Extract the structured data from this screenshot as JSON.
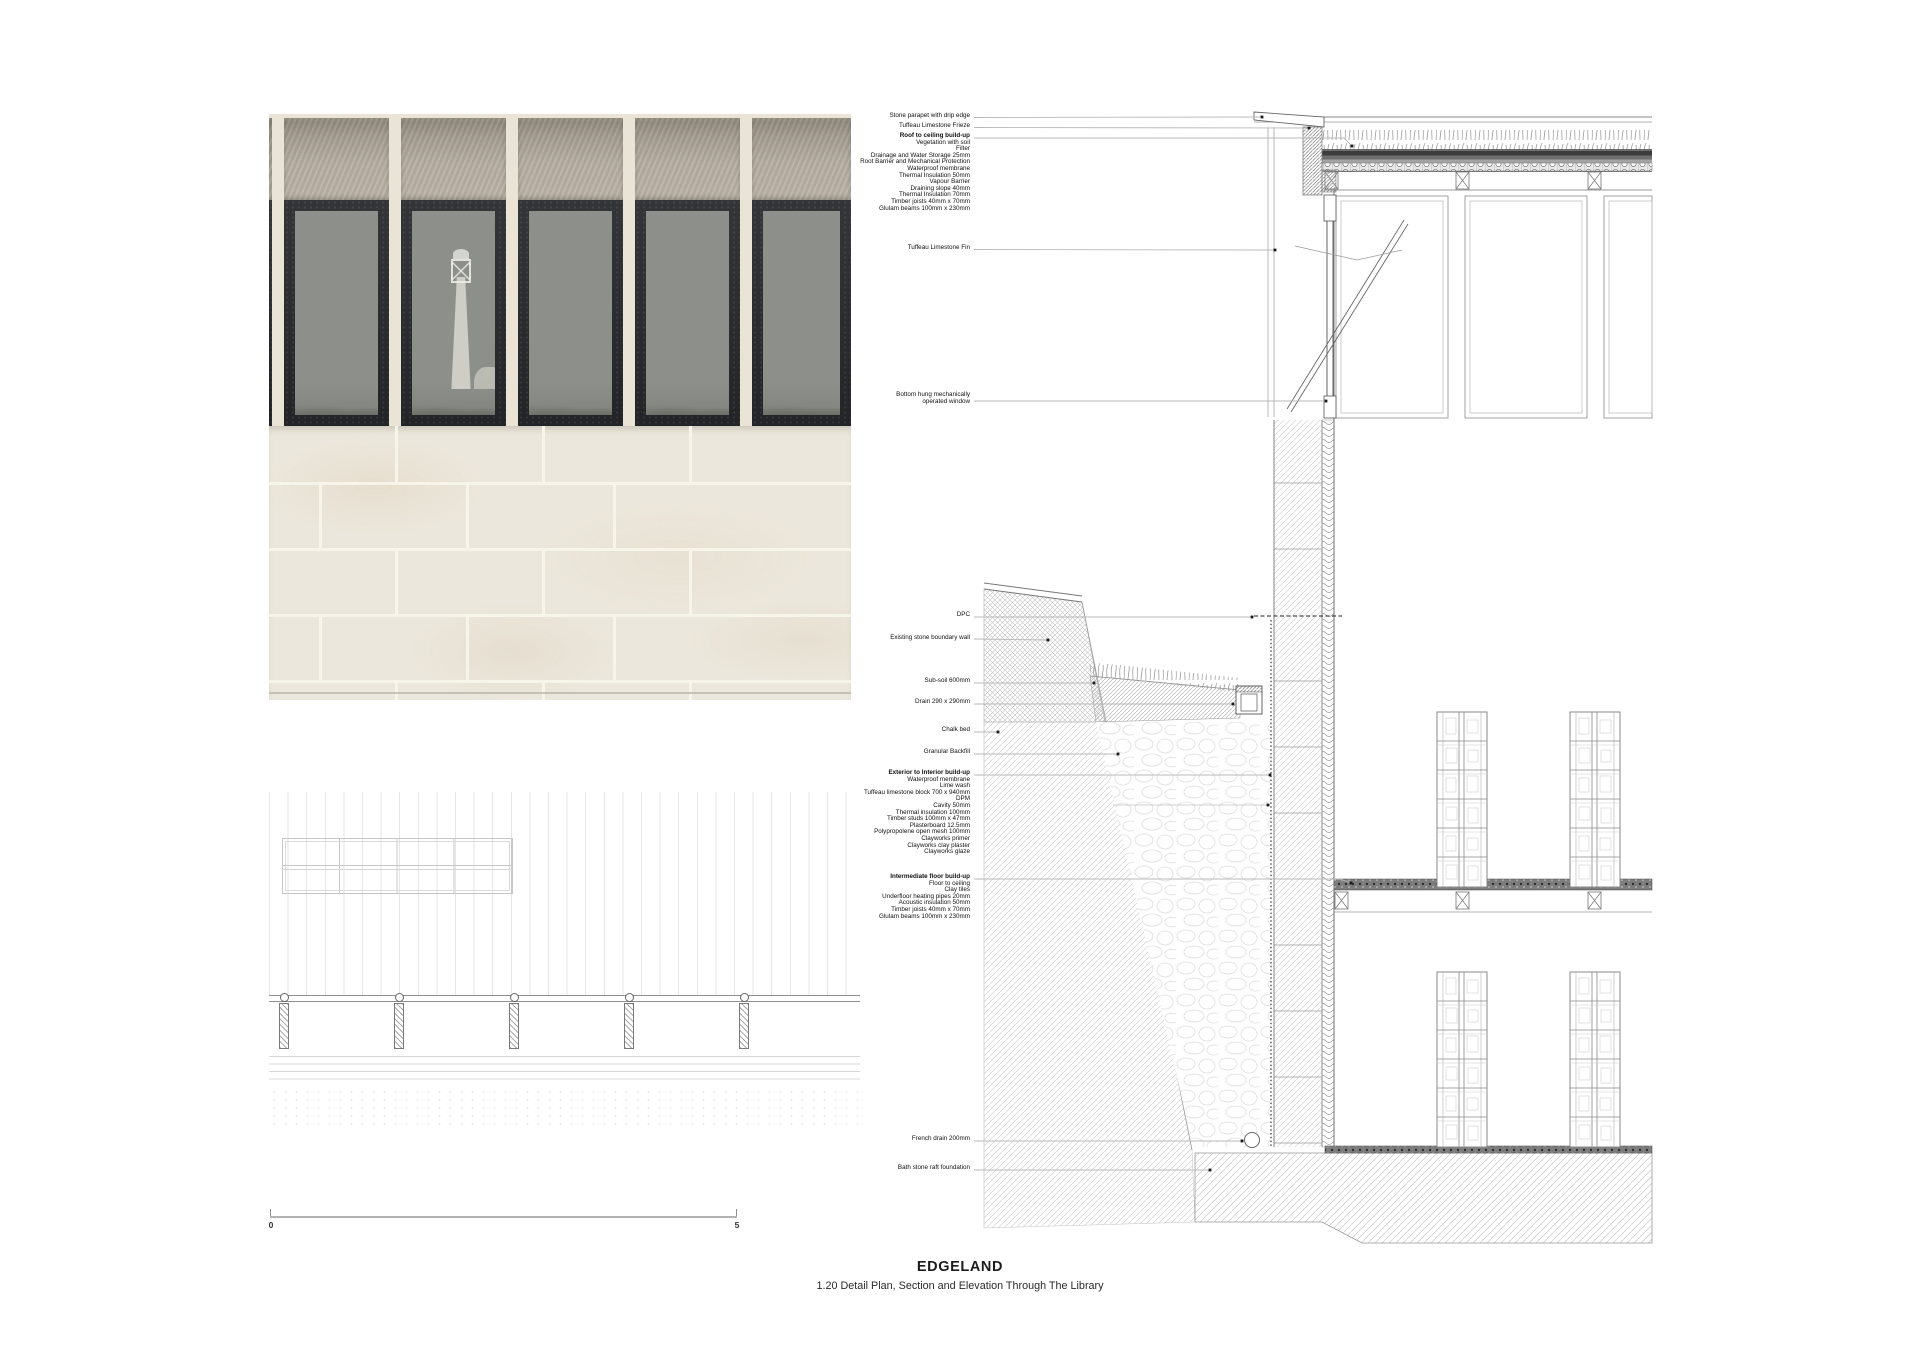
{
  "title_block": {
    "project": "EDGELAND",
    "drawing_title": "1.20 Detail Plan, Section and Elevation Through The Library"
  },
  "scale_bar": {
    "start_label": "0",
    "end_label": "5"
  },
  "colors": {
    "stone_cream": "#eae4d6",
    "frieze_grey": "#b2aa9d",
    "window_frame_charcoal": "#2d2e30",
    "glass_grey": "#8d908a",
    "drawing_line_grey": "#8a8a8a",
    "leader_grey": "#b9b9b9"
  },
  "annotations": [
    {
      "id": "stone-parapet",
      "heading": "Stone parapet with drip edge",
      "bold": false
    },
    {
      "id": "limestone-frieze",
      "heading": "Tuffeau Limestone Frieze",
      "bold": false
    },
    {
      "id": "roof-buildup",
      "heading": "Roof to ceiling build-up",
      "bold": true,
      "items": [
        "Vegetation with soil",
        "Filter",
        "Drainage and Water Storage 25mm",
        "Root Barrier and Mechanical Protection",
        "Waterproof membrane",
        "Thermal Insulation 50mm",
        "Vapour Barrier",
        "Draining slope 40mm",
        "Thermal Insulation 70mm",
        "Timber joists 40mm x 70mm",
        "Glulam beams 100mm x 230mm"
      ]
    },
    {
      "id": "limestone-fin",
      "heading": "Tuffeau Limestone Fin",
      "bold": false
    },
    {
      "id": "bottom-hung-window",
      "heading": "Bottom hung mechanically",
      "bold": false,
      "items": [
        "operated window"
      ]
    },
    {
      "id": "dpc",
      "heading": "DPC",
      "bold": false
    },
    {
      "id": "boundary-wall",
      "heading": "Existing stone boundary wall",
      "bold": false
    },
    {
      "id": "sub-soil",
      "heading": "Sub-soil 600mm",
      "bold": false
    },
    {
      "id": "drain",
      "heading": "Drain 290 x 290mm",
      "bold": false
    },
    {
      "id": "chalk-bed",
      "heading": "Chalk bed",
      "bold": false
    },
    {
      "id": "granular-backfill",
      "heading": "Granular Backfill",
      "bold": false
    },
    {
      "id": "exterior-interior-buildup",
      "heading": "Exterior to Interior build-up",
      "bold": true,
      "items": [
        "Waterproof membrane",
        "Lime wash",
        "Tuffeau limestone block 700 x 940mm",
        "DPM",
        "Cavity 50mm",
        "Thermal insulation 100mm",
        "Timber studs 100mm x 47mm",
        "Plasterboard 12.5mm",
        "Polypropolene open mesh 100mm",
        "Clayworks primer",
        "Clayworks clay plaster",
        "Clayworks glaze"
      ]
    },
    {
      "id": "intermediate-floor-buildup",
      "heading": "Intermediate floor build-up",
      "bold": true,
      "items": [
        "Floor to ceiling",
        "Clay tiles",
        "Underfloor heating pipes 20mm",
        "Acoustic insulation 50mm",
        "Timber joists 40mm x 70mm",
        "Glulam beams 100mm x 230mm"
      ]
    },
    {
      "id": "french-drain",
      "heading": "French drain 200mm",
      "bold": false
    },
    {
      "id": "raft-foundation",
      "heading": "Bath stone raft foundation",
      "bold": false
    }
  ]
}
